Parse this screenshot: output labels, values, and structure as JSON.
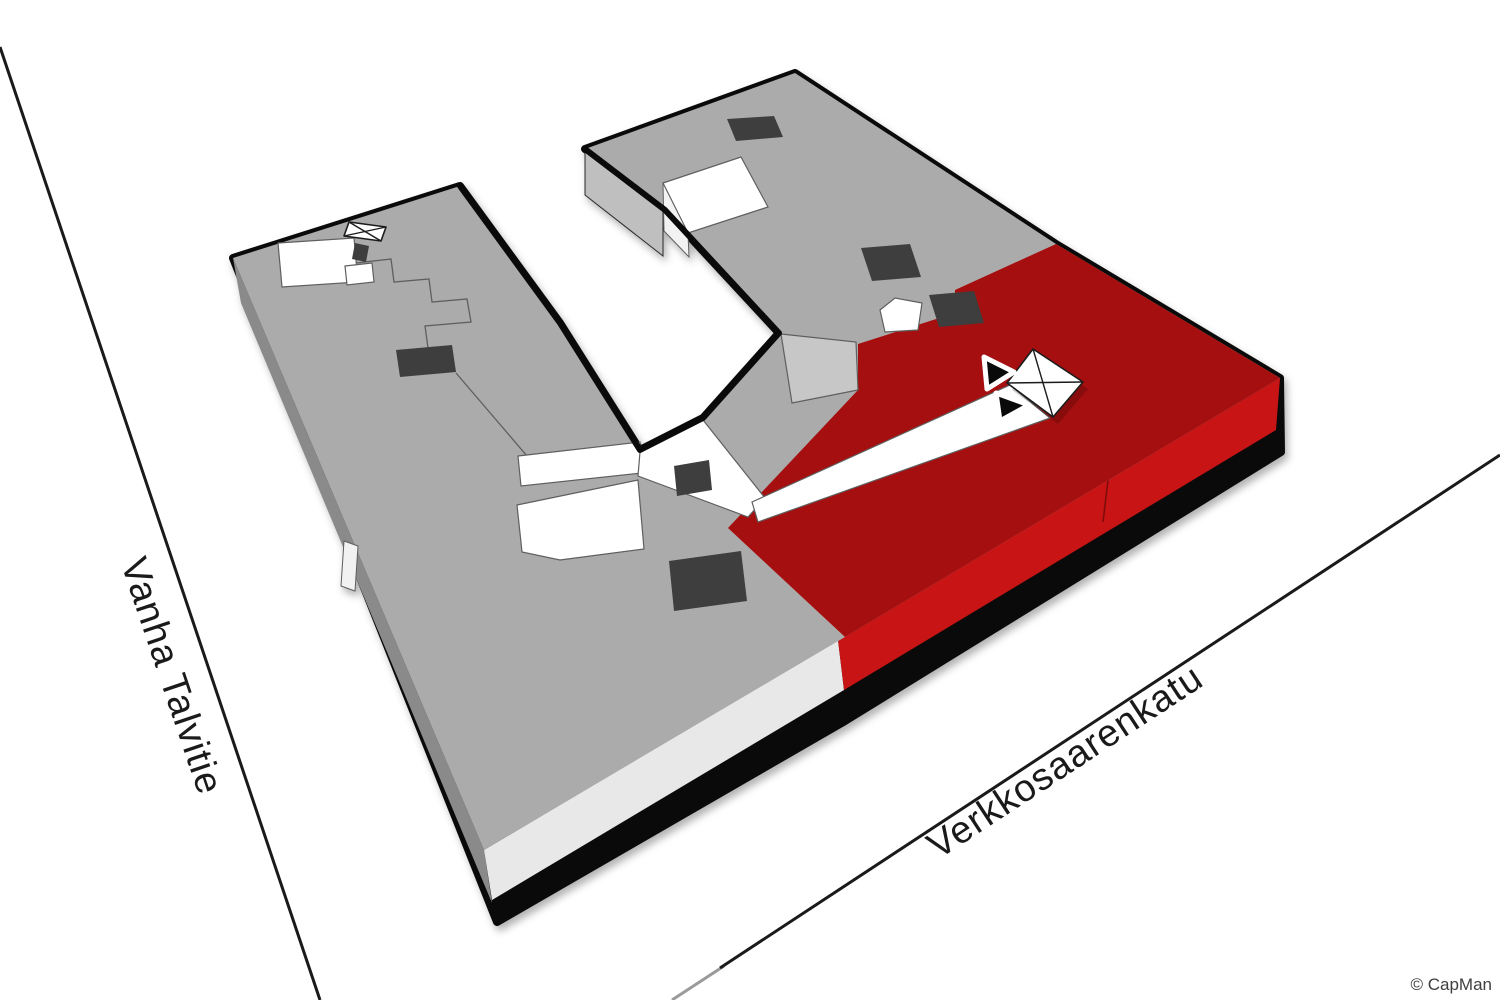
{
  "scene": {
    "copyright": "© CapMan"
  },
  "streets": [
    {
      "id": "vanha-talvitie",
      "label": "Vanha Talvitie"
    },
    {
      "id": "verkkosaarenkatu",
      "label": "Verkkosaarenkatu"
    }
  ],
  "icons": [
    "elevator-cross-square-icon",
    "direction-arrow-icon"
  ],
  "colors": {
    "building_gray": "#ABABAB",
    "roof_patch_light": "#C7C7C7",
    "side_light": "#E8E8E8",
    "side_mid": "#BFBFBF",
    "side_dark": "#8A8A8A",
    "red_top": "#A60F0F",
    "red_side": "#C81414",
    "dark_patch": "#3E3E3E",
    "white": "#FFFFFF",
    "outline": "#0A0A0A",
    "seam": "#5F5F5F",
    "street_line": "#1A1A1A",
    "label_text": "#1A1A1A",
    "copyright_text": "#3F3F3F",
    "marker_black": "#0A0A0A",
    "marker_halo": "#FFFFFF"
  }
}
